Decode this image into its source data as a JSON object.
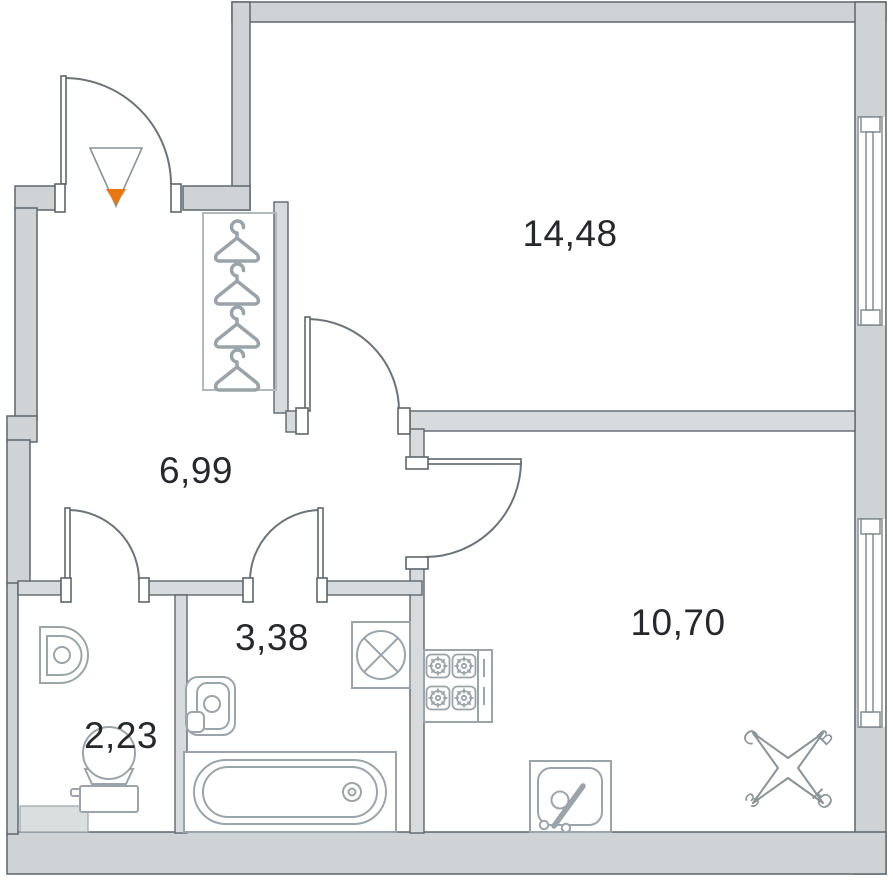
{
  "plan": {
    "title": "apartment-floor-plan",
    "rooms": {
      "bedroom": {
        "area": "14,48"
      },
      "hallway": {
        "area": "6,99"
      },
      "bathroom": {
        "area": "3,38"
      },
      "wc": {
        "area": "2,23"
      },
      "kitchen": {
        "area": "10,70"
      }
    },
    "compass": {
      "north": "С",
      "east": "В",
      "west": "З",
      "south": "Ю"
    },
    "colors": {
      "wall_fill": "#cfd3d6",
      "partition_fill": "#d7dbdd",
      "outline": "#5d676e",
      "fixture_stroke": "#9aa5ab",
      "entrance_arrow": "#e87611",
      "label_text": "#26292c",
      "compass_text": "#8a949b"
    }
  }
}
